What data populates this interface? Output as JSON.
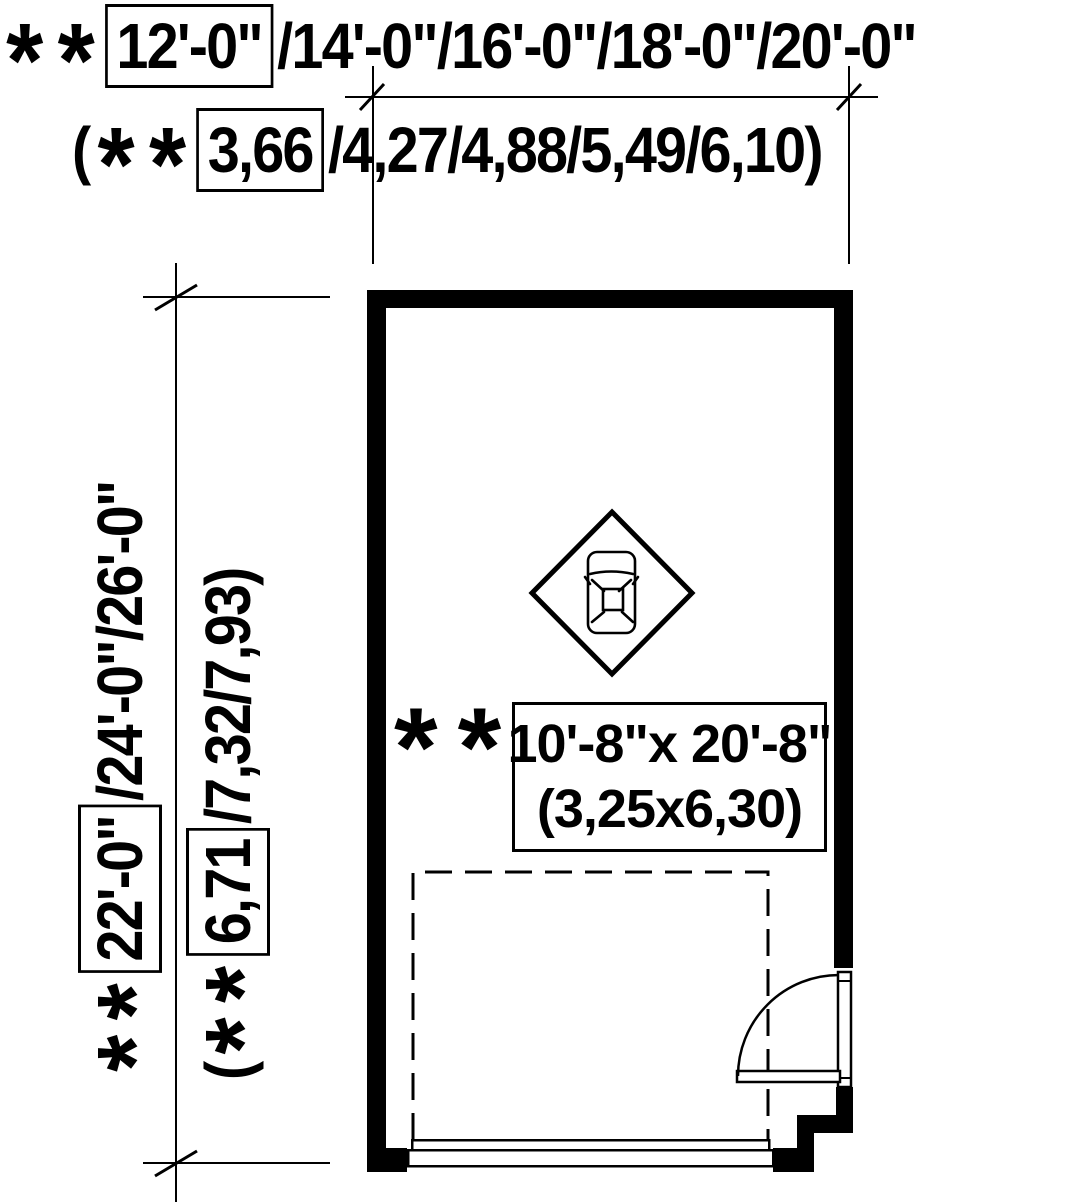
{
  "top_dim": {
    "feet": {
      "boxed": "12'-0\"",
      "alternatives": "/14'-0\"/16'-0\"/18'-0\"/20'-0\""
    },
    "meters": {
      "prefix": "(",
      "boxed": "3,66",
      "alternatives": "/4,27/4,88/5,49/6,10)"
    }
  },
  "left_dim": {
    "feet": {
      "boxed": "22'-0\"",
      "alternatives": "/24'-0\"/26'-0\""
    },
    "meters": {
      "prefix": "(",
      "boxed": "6,71",
      "alternatives": "/7,32/7,93)"
    }
  },
  "garage_label": {
    "imperial": "10'-8\"x 20'-8\"",
    "metric": "(3,25x6,30)"
  },
  "symbols": {
    "asterisk": "*"
  },
  "colors": {
    "ink": "#000000",
    "paper": "#ffffff"
  }
}
